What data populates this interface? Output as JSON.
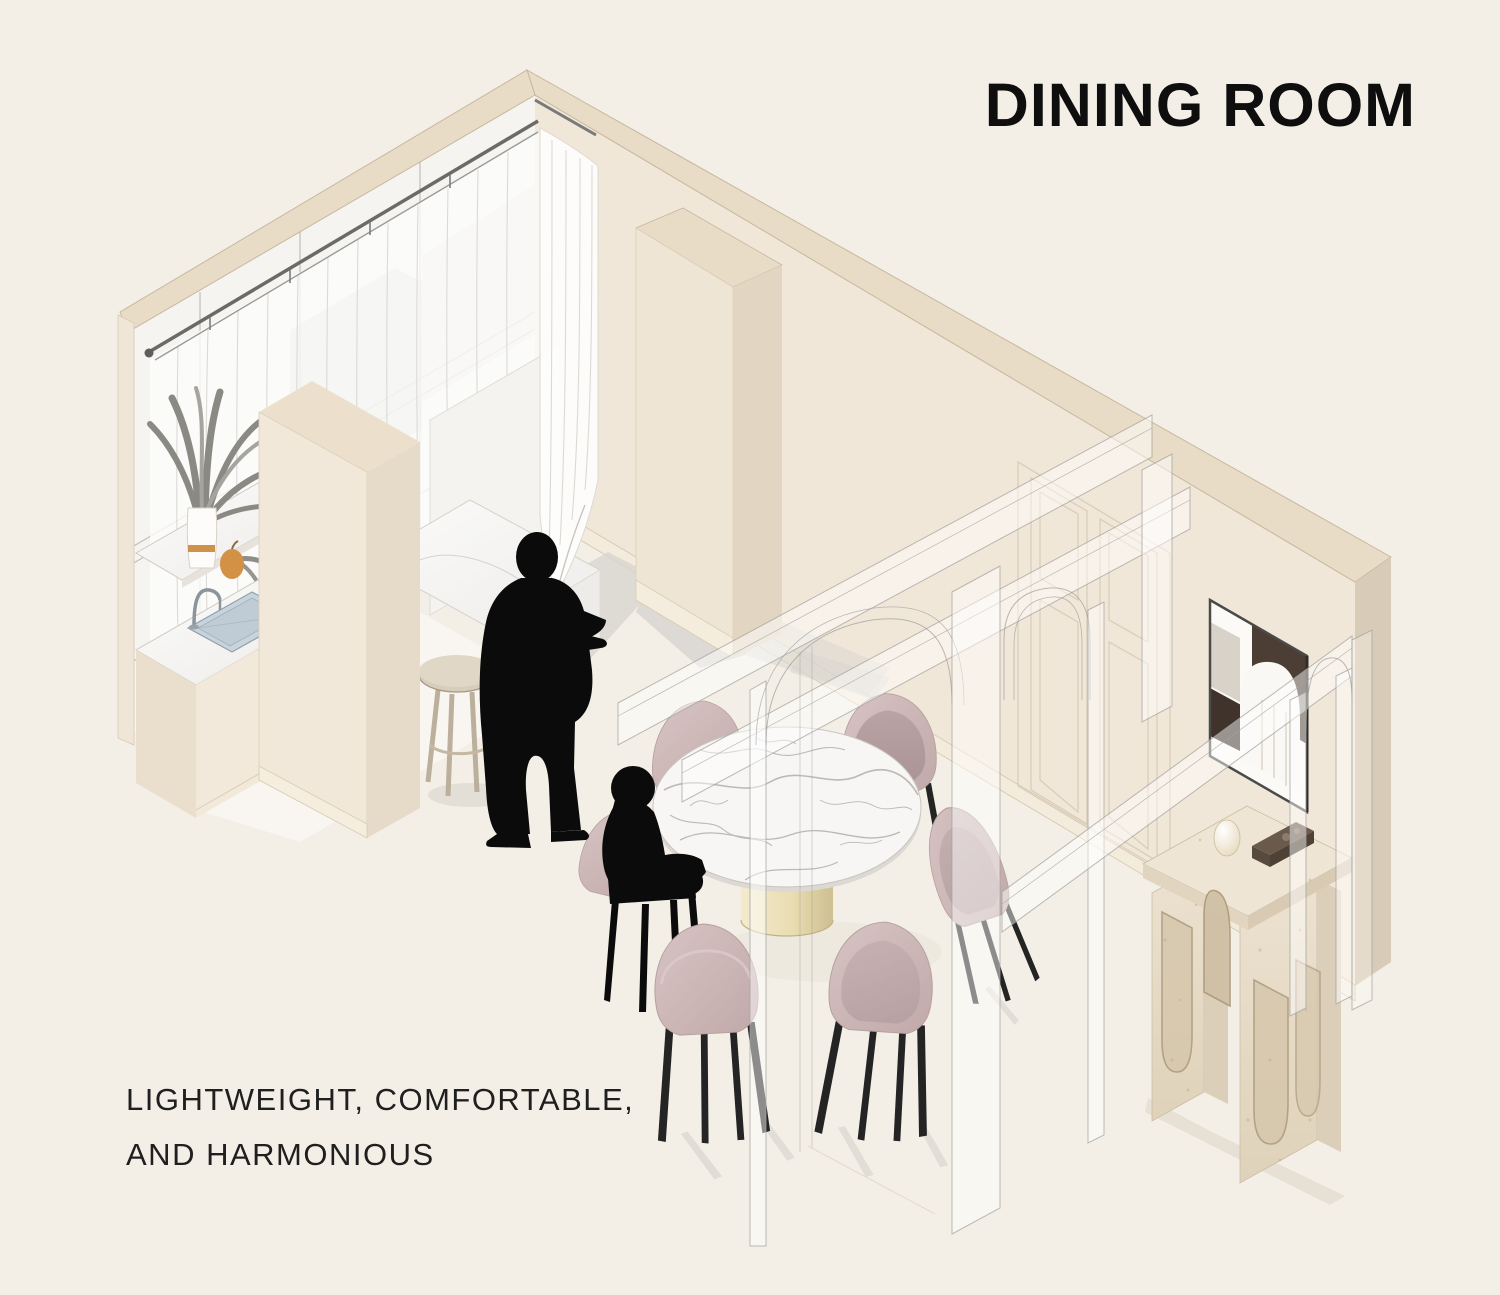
{
  "title": {
    "text": "DINING ROOM"
  },
  "caption": {
    "line1": "LIGHTWEIGHT, COMFORTABLE,",
    "line2": "AND HARMONIOUS"
  },
  "palette": {
    "bg": "#f4efe6",
    "ink": "#0e0e0e",
    "caption_ink": "#1f1f1f",
    "wall": "#f1e7d9",
    "wall_cut": "#e9dcc7",
    "wall_side": "#d8ccb8",
    "wall_line": "#c6b79e",
    "baseboard": "#f3ebdb",
    "glass": "#f6f4f0",
    "reflection": "#d8d7d4",
    "curtain": "#fcfcfb",
    "floor_shadow": "#d8d5d0",
    "marble": "#f7f6f4",
    "marble_vein": "#a8a4a0",
    "chair": "#cbb5b5",
    "chair_dark": "#b29b9d",
    "chair_leg": "#242424",
    "silhouette": "#0b0b0b",
    "wood": "#d7cdbb",
    "brass": "#eee4c0",
    "brass_dark": "#cfc094",
    "travertine": "#e9decc",
    "travertine_spot": "#c5b296",
    "art_brown": "#4c3e34",
    "steel": "#c9d3db",
    "accent_orange": "#cc8c3e",
    "ghost_line": "#a3a39f"
  }
}
